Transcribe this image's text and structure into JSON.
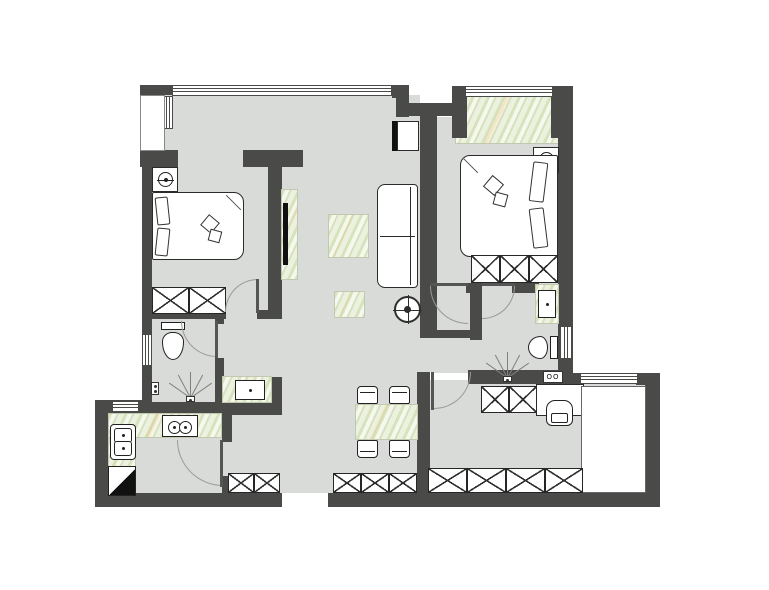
{
  "canvas": {
    "width": 769,
    "height": 590,
    "background": "#ffffff"
  },
  "palette": {
    "wall": "#4a4a48",
    "floor": "#d9dbd8",
    "line": "#2b2b2b",
    "marble": "#e9eedb",
    "arc": "#999999",
    "fixture_white": "#ffffff"
  },
  "elements": [
    {
      "name": "floor-main",
      "type": "floor",
      "x": 152,
      "y": 95,
      "w": 268,
      "h": 398
    },
    {
      "name": "floor-kitchen",
      "type": "floor",
      "x": 108,
      "y": 402,
      "w": 116,
      "h": 91
    },
    {
      "name": "floor-master-bedroom",
      "type": "floor",
      "x": 433,
      "y": 117,
      "w": 127,
      "h": 256
    },
    {
      "name": "floor-master-bath",
      "type": "floor",
      "x": 468,
      "y": 283,
      "w": 92,
      "h": 90
    },
    {
      "name": "floor-passage",
      "type": "floor",
      "x": 418,
      "y": 288,
      "w": 52,
      "h": 84
    },
    {
      "name": "floor-study",
      "type": "floor",
      "x": 425,
      "y": 380,
      "w": 222,
      "h": 113
    },
    {
      "name": "bay-window-sill",
      "type": "marble",
      "x": 455,
      "y": 96,
      "w": 108,
      "h": 48
    },
    {
      "name": "wall-top-left",
      "type": "wall",
      "x": 140,
      "y": 85,
      "w": 34,
      "h": 10
    },
    {
      "name": "wall-bay-left-block",
      "type": "wall",
      "x": 140,
      "y": 150,
      "w": 38,
      "h": 17
    },
    {
      "name": "wall-left-upper",
      "type": "wall",
      "x": 142,
      "y": 150,
      "w": 10,
      "h": 185
    },
    {
      "name": "wall-left-lower",
      "type": "wall",
      "x": 142,
      "y": 365,
      "w": 10,
      "h": 40
    },
    {
      "name": "wall-top-right-corner",
      "type": "wall",
      "x": 392,
      "y": 85,
      "w": 17,
      "h": 13
    },
    {
      "name": "wall-entry-stub",
      "type": "wall",
      "x": 396,
      "y": 85,
      "w": 13,
      "h": 32
    },
    {
      "name": "wall-master-north-link",
      "type": "wall",
      "x": 402,
      "y": 103,
      "w": 56,
      "h": 13
    },
    {
      "name": "wall-living-master-divider",
      "type": "wall",
      "x": 420,
      "y": 103,
      "w": 17,
      "h": 229
    },
    {
      "name": "wall-bay-column-left",
      "type": "wall",
      "x": 452,
      "y": 86,
      "w": 15,
      "h": 52
    },
    {
      "name": "wall-bay-column-right",
      "type": "wall",
      "x": 551,
      "y": 86,
      "w": 16,
      "h": 52
    },
    {
      "name": "wall-right-exterior",
      "type": "wall",
      "x": 558,
      "y": 86,
      "w": 15,
      "h": 290
    },
    {
      "name": "wall-study-north-a",
      "type": "wall",
      "x": 560,
      "y": 373,
      "w": 22,
      "h": 12
    },
    {
      "name": "wall-study-north-b",
      "type": "wall",
      "x": 636,
      "y": 373,
      "w": 24,
      "h": 12
    },
    {
      "name": "wall-study-east",
      "type": "wall",
      "x": 645,
      "y": 373,
      "w": 15,
      "h": 134
    },
    {
      "name": "wall-bottom-a",
      "type": "wall",
      "x": 95,
      "y": 493,
      "w": 187,
      "h": 14
    },
    {
      "name": "wall-bottom-b",
      "type": "wall",
      "x": 328,
      "y": 493,
      "w": 332,
      "h": 14
    },
    {
      "name": "wall-kitchen-north",
      "type": "wall",
      "x": 95,
      "y": 400,
      "w": 57,
      "h": 13
    },
    {
      "name": "wall-kitchen-west",
      "type": "wall",
      "x": 95,
      "y": 400,
      "w": 13,
      "h": 107
    },
    {
      "name": "wall-bath1-south",
      "type": "wall",
      "x": 142,
      "y": 402,
      "w": 80,
      "h": 11
    },
    {
      "name": "wall-bedroom1-south-a",
      "type": "wall",
      "x": 142,
      "y": 310,
      "w": 84,
      "h": 9
    },
    {
      "name": "wall-bedroom1-south-b",
      "type": "wall",
      "x": 257,
      "y": 310,
      "w": 25,
      "h": 9
    },
    {
      "name": "wall-partition-header",
      "type": "wall",
      "x": 243,
      "y": 150,
      "w": 60,
      "h": 17
    },
    {
      "name": "wall-partition-stem",
      "type": "wall",
      "x": 268,
      "y": 167,
      "w": 14,
      "h": 152
    },
    {
      "name": "wall-bath1-east-stub",
      "type": "wall",
      "x": 215,
      "y": 318,
      "w": 9,
      "h": 6
    },
    {
      "name": "wall-bath1-east",
      "type": "wall",
      "x": 215,
      "y": 358,
      "w": 9,
      "h": 47
    },
    {
      "name": "wall-vanity-south",
      "type": "wall",
      "x": 222,
      "y": 402,
      "w": 60,
      "h": 13
    },
    {
      "name": "wall-vanity-east-block",
      "type": "wall",
      "x": 270,
      "y": 377,
      "w": 12,
      "h": 27
    },
    {
      "name": "wall-kitchen-east-a",
      "type": "wall",
      "x": 222,
      "y": 415,
      "w": 10,
      "h": 27
    },
    {
      "name": "wall-kitchen-east-b",
      "type": "wall",
      "x": 222,
      "y": 476,
      "w": 10,
      "h": 19
    },
    {
      "name": "wall-master-south-a",
      "type": "wall",
      "x": 466,
      "y": 283,
      "w": 16,
      "h": 10
    },
    {
      "name": "wall-master-south-b",
      "type": "wall",
      "x": 512,
      "y": 283,
      "w": 27,
      "h": 10
    },
    {
      "name": "wall-masterbath-west",
      "type": "wall",
      "x": 470,
      "y": 283,
      "w": 12,
      "h": 57
    },
    {
      "name": "wall-passage-south",
      "type": "wall",
      "x": 420,
      "y": 330,
      "w": 62,
      "h": 8
    },
    {
      "name": "wall-masterbath-south",
      "type": "wall",
      "x": 468,
      "y": 370,
      "w": 94,
      "h": 14
    },
    {
      "name": "wall-study-west",
      "type": "wall",
      "x": 417,
      "y": 372,
      "w": 13,
      "h": 121
    },
    {
      "name": "window-living-north",
      "type": "window-h",
      "x": 172,
      "y": 85,
      "w": 220,
      "h": 11
    },
    {
      "name": "window-bay-north",
      "type": "window-h",
      "x": 465,
      "y": 86,
      "w": 88,
      "h": 11
    },
    {
      "name": "window-study-north",
      "type": "window-h",
      "x": 580,
      "y": 373,
      "w": 58,
      "h": 11
    },
    {
      "name": "window-kitchen-west",
      "type": "window-h",
      "x": 112,
      "y": 401,
      "w": 27,
      "h": 11
    },
    {
      "name": "window-bath1-west",
      "type": "window-v",
      "x": 142,
      "y": 334,
      "w": 10,
      "h": 32
    },
    {
      "name": "window-masterbath-east",
      "type": "window-v",
      "x": 560,
      "y": 326,
      "w": 12,
      "h": 33
    },
    {
      "name": "window-bay-side",
      "type": "window-v",
      "x": 163,
      "y": 96,
      "w": 10,
      "h": 33
    },
    {
      "name": "bay-structure",
      "type": "bay",
      "x": 140,
      "y": 95,
      "w": 25,
      "h": 56
    },
    {
      "name": "entry-opening",
      "type": "entry-gap",
      "x": 282,
      "y": 493,
      "w": 46,
      "h": 15
    },
    {
      "name": "tv-backdrop-panel",
      "type": "marble",
      "x": 281,
      "y": 189,
      "w": 17,
      "h": 91
    },
    {
      "name": "coffee-table",
      "type": "marble",
      "x": 328,
      "y": 214,
      "w": 41,
      "h": 44
    },
    {
      "name": "side-table",
      "type": "marble",
      "x": 334,
      "y": 291,
      "w": 31,
      "h": 27
    },
    {
      "name": "dining-table",
      "type": "marble",
      "x": 355,
      "y": 404,
      "w": 63,
      "h": 36
    },
    {
      "name": "hall-vanity-counter",
      "type": "marble",
      "x": 222,
      "y": 376,
      "w": 50,
      "h": 27
    },
    {
      "name": "masterbath-vanity-counter",
      "type": "marble",
      "x": 535,
      "y": 284,
      "w": 24,
      "h": 40
    },
    {
      "name": "kitchen-counter-north",
      "type": "marble",
      "x": 108,
      "y": 413,
      "w": 114,
      "h": 25
    },
    {
      "name": "kitchen-counter-west",
      "type": "marble",
      "x": 108,
      "y": 438,
      "w": 28,
      "h": 33
    },
    {
      "name": "nightstand-bedroom1",
      "type": "furn",
      "x": 152,
      "y": 167,
      "w": 26,
      "h": 25
    },
    {
      "name": "lamp-bedroom1-icon",
      "type": "lamp",
      "x": 158,
      "y": 172,
      "w": 15,
      "h": 15
    },
    {
      "name": "bed-bedroom1",
      "type": "bed",
      "dir": "right",
      "x": 152,
      "y": 192,
      "w": 92,
      "h": 68
    },
    {
      "name": "pillow-bedroom1-a",
      "type": "pillow",
      "x": 156,
      "y": 197,
      "w": 13,
      "h": 28,
      "rot": -6
    },
    {
      "name": "pillow-bedroom1-b",
      "type": "pillow",
      "x": 156,
      "y": 228,
      "w": 13,
      "h": 28,
      "rot": 6
    },
    {
      "name": "bed-deco-bedroom1-a",
      "type": "deco",
      "x": 203,
      "y": 217,
      "w": 14,
      "h": 14,
      "rot": 40
    },
    {
      "name": "bed-deco-bedroom1-b",
      "type": "deco",
      "x": 209,
      "y": 230,
      "w": 12,
      "h": 12,
      "rot": 15
    },
    {
      "name": "wardrobe-bedroom1-a",
      "type": "xbox",
      "x": 152,
      "y": 287,
      "w": 37,
      "h": 27
    },
    {
      "name": "wardrobe-bedroom1-b",
      "type": "xbox",
      "x": 189,
      "y": 287,
      "w": 37,
      "h": 27
    },
    {
      "name": "tv-living",
      "type": "tv",
      "x": 283,
      "y": 203,
      "w": 5,
      "h": 62
    },
    {
      "name": "sofa",
      "type": "sofa",
      "x": 377,
      "y": 184,
      "w": 41,
      "h": 104
    },
    {
      "name": "ceiling-fan-symbol",
      "type": "compass",
      "x": 394,
      "y": 296,
      "w": 27,
      "h": 27
    },
    {
      "name": "shoe-cabinet",
      "type": "furn",
      "x": 397,
      "y": 121,
      "w": 22,
      "h": 30
    },
    {
      "name": "shoe-cabinet-side-panel",
      "type": "tv",
      "x": 392,
      "y": 121,
      "w": 5,
      "h": 30
    },
    {
      "name": "nightstand-master",
      "type": "furn",
      "x": 533,
      "y": 147,
      "w": 26,
      "h": 26
    },
    {
      "name": "lamp-master-icon",
      "type": "lamp",
      "x": 539,
      "y": 152,
      "w": 15,
      "h": 15
    },
    {
      "name": "bed-master",
      "type": "bed",
      "dir": "left",
      "x": 460,
      "y": 155,
      "w": 98,
      "h": 102
    },
    {
      "name": "pillow-master-a",
      "type": "pillow",
      "x": 531,
      "y": 162,
      "w": 15,
      "h": 40,
      "rot": 7
    },
    {
      "name": "pillow-master-b",
      "type": "pillow",
      "x": 531,
      "y": 208,
      "w": 15,
      "h": 40,
      "rot": -7
    },
    {
      "name": "bed-deco-master-a",
      "type": "deco",
      "x": 486,
      "y": 178,
      "w": 15,
      "h": 15,
      "rot": 40
    },
    {
      "name": "bed-deco-master-b",
      "type": "deco",
      "x": 494,
      "y": 193,
      "w": 13,
      "h": 13,
      "rot": 15
    },
    {
      "name": "wardrobe-master-a",
      "type": "xbox",
      "x": 471,
      "y": 255,
      "w": 29,
      "h": 28
    },
    {
      "name": "wardrobe-master-b",
      "type": "xbox",
      "x": 500,
      "y": 255,
      "w": 29,
      "h": 28
    },
    {
      "name": "wardrobe-master-c",
      "type": "xbox",
      "x": 529,
      "y": 255,
      "w": 29,
      "h": 28
    },
    {
      "name": "toilet-bath1",
      "type": "toilet",
      "dir": "down",
      "x": 159,
      "y": 321,
      "w": 28,
      "h": 40
    },
    {
      "name": "shower-spray-bath1",
      "type": "fan",
      "x": 176,
      "y": 372,
      "w": 28,
      "h": 26
    },
    {
      "name": "floor-drain-bath1",
      "type": "drain",
      "x": 186,
      "y": 396,
      "w": 9,
      "h": 6
    },
    {
      "name": "wall-drain-bath1",
      "type": "drain",
      "x": 151,
      "y": 382,
      "w": 8,
      "h": 13
    },
    {
      "name": "hall-vanity-sink",
      "type": "sink",
      "x": 235,
      "y": 380,
      "w": 30,
      "h": 20
    },
    {
      "name": "kitchen-sink",
      "type": "sink-double",
      "x": 110,
      "y": 424,
      "w": 26,
      "h": 36
    },
    {
      "name": "kitchen-stove",
      "type": "stove",
      "x": 162,
      "y": 415,
      "w": 36,
      "h": 22
    },
    {
      "name": "fridge",
      "type": "fridge",
      "x": 108,
      "y": 466,
      "w": 28,
      "h": 30
    },
    {
      "name": "masterbath-sink",
      "type": "sink",
      "x": 538,
      "y": 290,
      "w": 18,
      "h": 28
    },
    {
      "name": "toilet-masterbath",
      "type": "toilet",
      "dir": "left",
      "x": 527,
      "y": 334,
      "w": 32,
      "h": 27
    },
    {
      "name": "shower-spray-masterbath",
      "type": "fan",
      "x": 493,
      "y": 352,
      "w": 28,
      "h": 26
    },
    {
      "name": "floor-drain-masterbath",
      "type": "drain",
      "x": 503,
      "y": 376,
      "w": 9,
      "h": 6
    },
    {
      "name": "washing-machine-symbol",
      "type": "label",
      "x": 543,
      "y": 371,
      "w": 20,
      "h": 12,
      "text": "OO"
    },
    {
      "name": "hall-cabinet-a",
      "type": "xbox",
      "x": 228,
      "y": 473,
      "w": 26,
      "h": 20
    },
    {
      "name": "hall-cabinet-b",
      "type": "xbox",
      "x": 254,
      "y": 473,
      "w": 26,
      "h": 20
    },
    {
      "name": "dining-cabinet-a",
      "type": "xbox",
      "x": 333,
      "y": 473,
      "w": 28,
      "h": 20
    },
    {
      "name": "dining-cabinet-b",
      "type": "xbox",
      "x": 361,
      "y": 473,
      "w": 28,
      "h": 20
    },
    {
      "name": "dining-cabinet-c",
      "type": "xbox",
      "x": 389,
      "y": 473,
      "w": 28,
      "h": 20
    },
    {
      "name": "dining-chair-nw",
      "type": "chair",
      "x": 357,
      "y": 386,
      "w": 21,
      "h": 18
    },
    {
      "name": "dining-chair-ne",
      "type": "chair",
      "x": 389,
      "y": 386,
      "w": 21,
      "h": 18
    },
    {
      "name": "dining-chair-sw",
      "type": "chair",
      "x": 357,
      "y": 440,
      "w": 21,
      "h": 18,
      "rot": 180
    },
    {
      "name": "dining-chair-se",
      "type": "chair",
      "x": 389,
      "y": 440,
      "w": 21,
      "h": 18,
      "rot": 180
    },
    {
      "name": "study-cabinet-a",
      "type": "xbox",
      "x": 481,
      "y": 386,
      "w": 28,
      "h": 27
    },
    {
      "name": "study-cabinet-b",
      "type": "xbox",
      "x": 509,
      "y": 386,
      "w": 28,
      "h": 27
    },
    {
      "name": "desk",
      "type": "furn",
      "x": 536,
      "y": 384,
      "w": 48,
      "h": 32
    },
    {
      "name": "desk-chair",
      "type": "armchair",
      "x": 546,
      "y": 400,
      "w": 27,
      "h": 26
    },
    {
      "name": "study-platform",
      "type": "platform",
      "x": 581,
      "y": 386,
      "w": 65,
      "h": 107
    },
    {
      "name": "study-wardrobe-a",
      "type": "xbox",
      "x": 428,
      "y": 468,
      "w": 39,
      "h": 25
    },
    {
      "name": "study-wardrobe-b",
      "type": "xbox",
      "x": 467,
      "y": 468,
      "w": 39,
      "h": 25
    },
    {
      "name": "study-wardrobe-c",
      "type": "xbox",
      "x": 506,
      "y": 468,
      "w": 39,
      "h": 25
    },
    {
      "name": "study-wardrobe-d",
      "type": "xbox",
      "x": 545,
      "y": 468,
      "w": 38,
      "h": 25
    },
    {
      "name": "door-bedroom1-arc",
      "type": "arc",
      "dir": "tl",
      "x": 225,
      "y": 279,
      "w": 33,
      "h": 33
    },
    {
      "name": "door-bedroom1-leaf",
      "type": "leaf",
      "x": 256,
      "y": 279,
      "w": 3,
      "h": 34
    },
    {
      "name": "door-bath1-arc",
      "type": "arc",
      "dir": "bl",
      "x": 181,
      "y": 321,
      "w": 36,
      "h": 36
    },
    {
      "name": "door-bath1-leaf",
      "type": "leaf",
      "x": 215,
      "y": 321,
      "w": 3,
      "h": 37
    },
    {
      "name": "door-kitchen-arc",
      "type": "arc",
      "dir": "bl",
      "x": 177,
      "y": 440,
      "w": 46,
      "h": 46
    },
    {
      "name": "door-kitchen-leaf",
      "type": "leaf",
      "x": 220,
      "y": 440,
      "w": 3,
      "h": 47
    },
    {
      "name": "door-master-arc",
      "type": "arc",
      "dir": "bl",
      "x": 430,
      "y": 286,
      "w": 38,
      "h": 38
    },
    {
      "name": "door-master-leaf",
      "type": "leaf",
      "x": 430,
      "y": 283,
      "w": 38,
      "h": 3
    },
    {
      "name": "door-masterbath-arc",
      "type": "arc",
      "dir": "br",
      "x": 482,
      "y": 286,
      "w": 33,
      "h": 33
    },
    {
      "name": "door-masterbath-leaf",
      "type": "leaf",
      "x": 482,
      "y": 283,
      "w": 33,
      "h": 3
    },
    {
      "name": "door-study-arc",
      "type": "arc",
      "dir": "br",
      "x": 434,
      "y": 372,
      "w": 37,
      "h": 37
    },
    {
      "name": "door-study-leaf",
      "type": "leaf",
      "x": 431,
      "y": 372,
      "w": 3,
      "h": 38
    }
  ]
}
